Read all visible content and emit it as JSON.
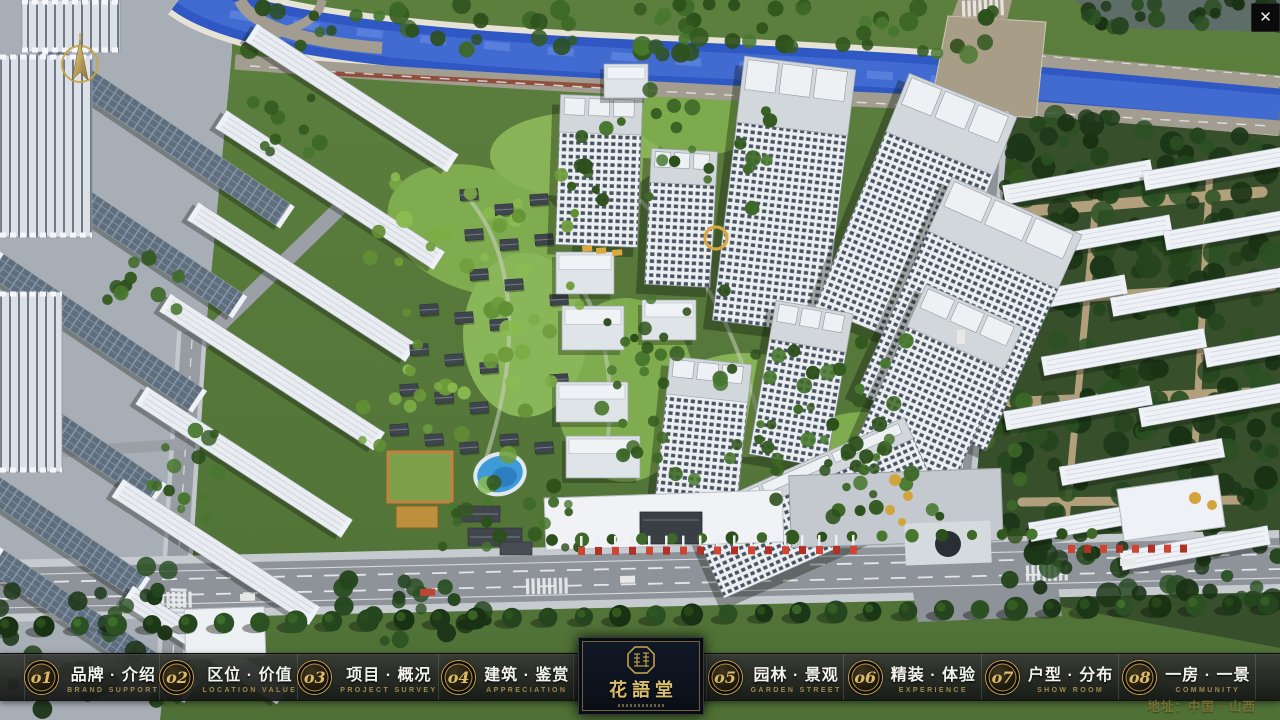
{
  "header": {
    "close_glyph": "✕"
  },
  "compass": {
    "icon": "compass-north-arrow"
  },
  "menu": {
    "items": [
      {
        "num": "o1",
        "title": "品牌 · 介绍",
        "subtitle": "BRAND SUPPORT"
      },
      {
        "num": "o2",
        "title": "区位 · 价值",
        "subtitle": "LOCATION VALUE"
      },
      {
        "num": "o3",
        "title": "项目 · 概况",
        "subtitle": "PROJECT SURVEY"
      },
      {
        "num": "o4",
        "title": "建筑 · 鉴赏",
        "subtitle": "APPRECIATION"
      },
      {
        "num": "o5",
        "title": "园林 · 景观",
        "subtitle": "GARDEN STREET"
      },
      {
        "num": "o6",
        "title": "精装 · 体验",
        "subtitle": "EXPERIENCE"
      },
      {
        "num": "o7",
        "title": "户型 · 分布",
        "subtitle": "SHOW ROOM"
      },
      {
        "num": "o8",
        "title": "一房 · 一景",
        "subtitle": "COMMUNITY"
      }
    ]
  },
  "logo": {
    "name": "花語堂",
    "seal_icon": "hua-yu-tang-seal"
  },
  "footer": {
    "address": "地址：中国 · 山西"
  },
  "colors": {
    "accent_gold": "#C9A85A",
    "bar_bg": "#1D1F1D",
    "panel_bg": "#0C1118",
    "title_text": "#F2F2EE",
    "subtitle_text": "#A18A4D",
    "river_blue": "#2F58C4"
  }
}
